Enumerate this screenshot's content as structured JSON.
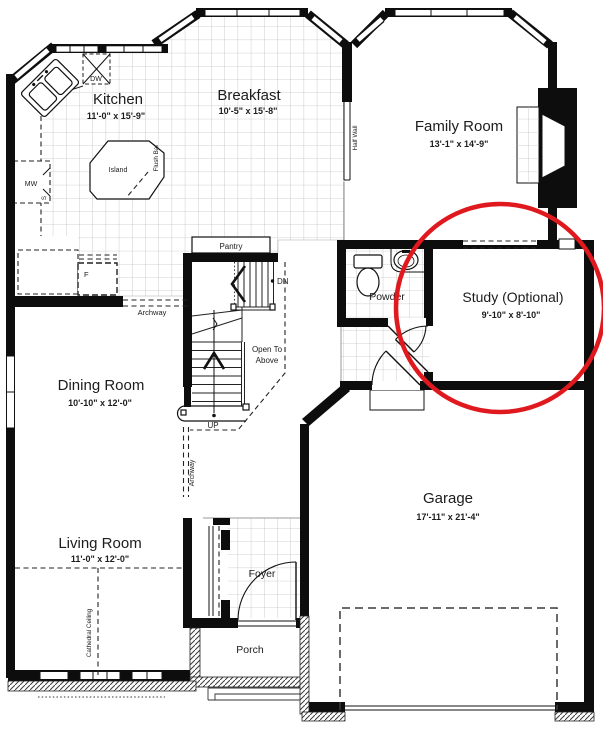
{
  "highlight": {
    "color": "#e0191e"
  },
  "rooms": {
    "kitchen": {
      "name": "Kitchen",
      "dims": "11'-0\" x 15'-9\""
    },
    "breakfast": {
      "name": "Breakfast",
      "dims": "10'-5\" x 15'-8\""
    },
    "family_room": {
      "name": "Family Room",
      "dims": "13'-1\" x 14'-9\""
    },
    "dining_room": {
      "name": "Dining Room",
      "dims": "10'-10\" x 12'-0\""
    },
    "living_room": {
      "name": "Living Room",
      "dims": "11'-0\" x 12'-0\""
    },
    "garage": {
      "name": "Garage",
      "dims": "17'-11\" x 21'-4\""
    },
    "study": {
      "name": "Study (Optional)",
      "dims": "9'-10\" x 8'-10\""
    },
    "powder": {
      "name": "Powder"
    },
    "foyer": {
      "name": "Foyer"
    },
    "porch": {
      "name": "Porch"
    }
  },
  "annotations": {
    "pantry": "Pantry",
    "island": "Island",
    "flush_bar": "Flush Bar",
    "half_wall": "Half Wall",
    "archway_kitchen": "Archway",
    "archway_hall": "Archway",
    "cathedral_ceiling": "Cathedral Ceiling",
    "open_to_above_line1": "Open To",
    "open_to_above_line2": "Above",
    "stairs_down": "DN",
    "stairs_up": "UP"
  },
  "appliances": {
    "dishwasher": "DW",
    "microwave": "MW",
    "stove": "S",
    "fridge": "F"
  }
}
